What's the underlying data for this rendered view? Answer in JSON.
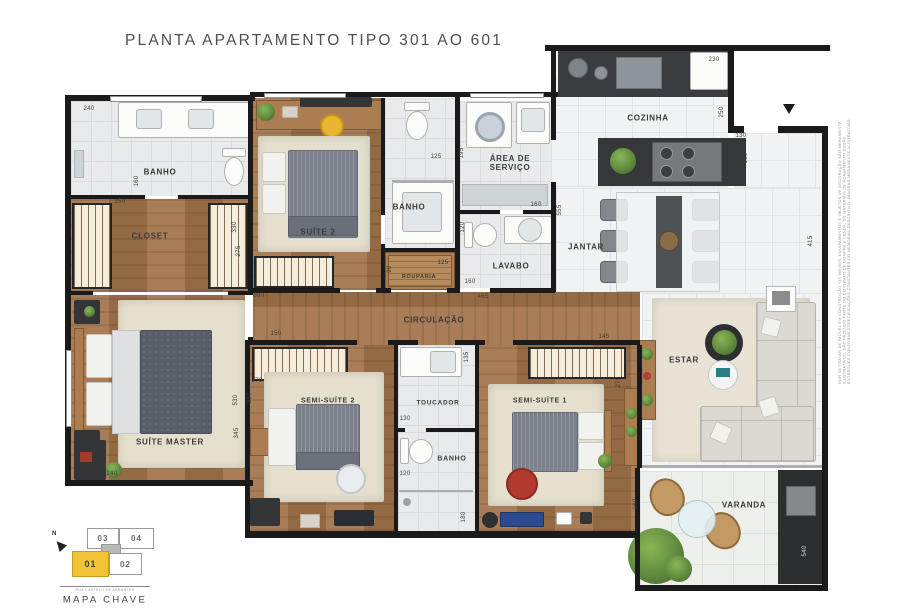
{
  "title": "PLANTA APARTAMENTO TIPO 301 AO 601",
  "room_labels": [
    {
      "id": "banho-master",
      "text": "BANHO",
      "x": 160,
      "y": 172
    },
    {
      "id": "closet",
      "text": "CLOSET",
      "x": 150,
      "y": 236
    },
    {
      "id": "suite-master",
      "text": "SUÍTE MASTER",
      "x": 170,
      "y": 442
    },
    {
      "id": "suite-2",
      "text": "SUÍTE 2",
      "x": 318,
      "y": 232
    },
    {
      "id": "banho-suite-2",
      "text": "BANHO",
      "x": 409,
      "y": 207
    },
    {
      "id": "area-servico",
      "text": "ÁREA DE SERVIÇO",
      "x": 510,
      "y": 163,
      "w": 64
    },
    {
      "id": "lavabo",
      "text": "LAVABO",
      "x": 511,
      "y": 266
    },
    {
      "id": "rouparia",
      "text": "ROUPARIA",
      "x": 419,
      "y": 277,
      "s": 5.5
    },
    {
      "id": "cozinha",
      "text": "COZINHA",
      "x": 648,
      "y": 118
    },
    {
      "id": "jantar",
      "text": "JANTAR",
      "x": 586,
      "y": 247
    },
    {
      "id": "circulacao",
      "text": "CIRCULAÇÃO",
      "x": 434,
      "y": 320
    },
    {
      "id": "estar",
      "text": "ESTAR",
      "x": 684,
      "y": 360
    },
    {
      "id": "semi-suite-2",
      "text": "SEMI-SUÍTE 2",
      "x": 328,
      "y": 401,
      "s": 7
    },
    {
      "id": "toucador",
      "text": "TOUCADOR",
      "x": 438,
      "y": 403,
      "s": 6.5
    },
    {
      "id": "semi-suite-1",
      "text": "SEMI-SUÍTE 1",
      "x": 540,
      "y": 401,
      "s": 7
    },
    {
      "id": "banho-semi-suites",
      "text": "BANHO",
      "x": 452,
      "y": 459,
      "s": 7
    },
    {
      "id": "varanda",
      "text": "VARANDA",
      "x": 744,
      "y": 505
    }
  ],
  "dimensions": [
    {
      "t": "240",
      "x": 89,
      "y": 109
    },
    {
      "t": "160",
      "x": 137,
      "y": 181,
      "v": 1
    },
    {
      "t": "350",
      "x": 120,
      "y": 202
    },
    {
      "t": "330",
      "x": 235,
      "y": 227,
      "v": 1
    },
    {
      "t": "275",
      "x": 239,
      "y": 251,
      "v": 1
    },
    {
      "t": "380",
      "x": 259,
      "y": 296
    },
    {
      "t": "125",
      "x": 436,
      "y": 157
    },
    {
      "t": "195",
      "x": 462,
      "y": 153,
      "v": 1
    },
    {
      "t": "230",
      "x": 714,
      "y": 60
    },
    {
      "t": "250",
      "x": 722,
      "y": 112,
      "v": 1
    },
    {
      "t": "130",
      "x": 741,
      "y": 136
    },
    {
      "t": "160",
      "x": 746,
      "y": 158,
      "v": 1
    },
    {
      "t": "555",
      "x": 560,
      "y": 210,
      "v": 1
    },
    {
      "t": "160",
      "x": 536,
      "y": 205
    },
    {
      "t": "120",
      "x": 463,
      "y": 227,
      "v": 1
    },
    {
      "t": "160",
      "x": 470,
      "y": 282
    },
    {
      "t": "125",
      "x": 443,
      "y": 263
    },
    {
      "t": "90",
      "x": 390,
      "y": 269,
      "v": 1
    },
    {
      "t": "465",
      "x": 483,
      "y": 297
    },
    {
      "t": "415",
      "x": 811,
      "y": 241,
      "v": 1
    },
    {
      "t": "145",
      "x": 604,
      "y": 337
    },
    {
      "t": "150",
      "x": 276,
      "y": 334
    },
    {
      "t": "270",
      "x": 257,
      "y": 381
    },
    {
      "t": "330",
      "x": 250,
      "y": 398,
      "v": 1
    },
    {
      "t": "530",
      "x": 236,
      "y": 400,
      "v": 1
    },
    {
      "t": "345",
      "x": 237,
      "y": 433,
      "v": 1
    },
    {
      "t": "270",
      "x": 619,
      "y": 382,
      "v": 1
    },
    {
      "t": "135",
      "x": 467,
      "y": 357,
      "v": 1
    },
    {
      "t": "130",
      "x": 405,
      "y": 419
    },
    {
      "t": "120",
      "x": 405,
      "y": 474
    },
    {
      "t": "180",
      "x": 464,
      "y": 517,
      "v": 1
    },
    {
      "t": "240",
      "x": 112,
      "y": 474
    },
    {
      "t": "160",
      "x": 636,
      "y": 504,
      "v": 1
    },
    {
      "t": "540",
      "x": 805,
      "y": 551,
      "v": 1,
      "light": 1
    }
  ],
  "keymap": {
    "units": [
      {
        "label": "03"
      },
      {
        "label": "04"
      },
      {
        "label": "01"
      },
      {
        "label": "02"
      }
    ],
    "north": "N",
    "street": "RUA CASTELO DE ABRANTES",
    "title": "MAPA CHAVE"
  },
  "disclaimer": "POR SE TRATAR DE IMÓVEL EM CONSTRUÇÃO, OS MÓVEIS, EQUIPAMENTOS E OBJETOS DE DECORAÇÃO SÃO MERAMENTE ILUSTRATIVOS, NÃO FAZENDO PARTE DO CONTRATO DE COMPRA E VENDA. OS MATERIAIS DE ACABAMENTO SERÃO ENTREGUES CONFORME ESPECIFICAÇÕES CONSTANTES DO MEMORIAL DESCRITIVO. IMAGENS MERAMENTE ILUSTRATIVAS.",
  "colors": {
    "accent_yellow": "#f0c435",
    "wood": "#a1734a",
    "tile": "#e9eaec",
    "wall": "#1a1a1a"
  }
}
